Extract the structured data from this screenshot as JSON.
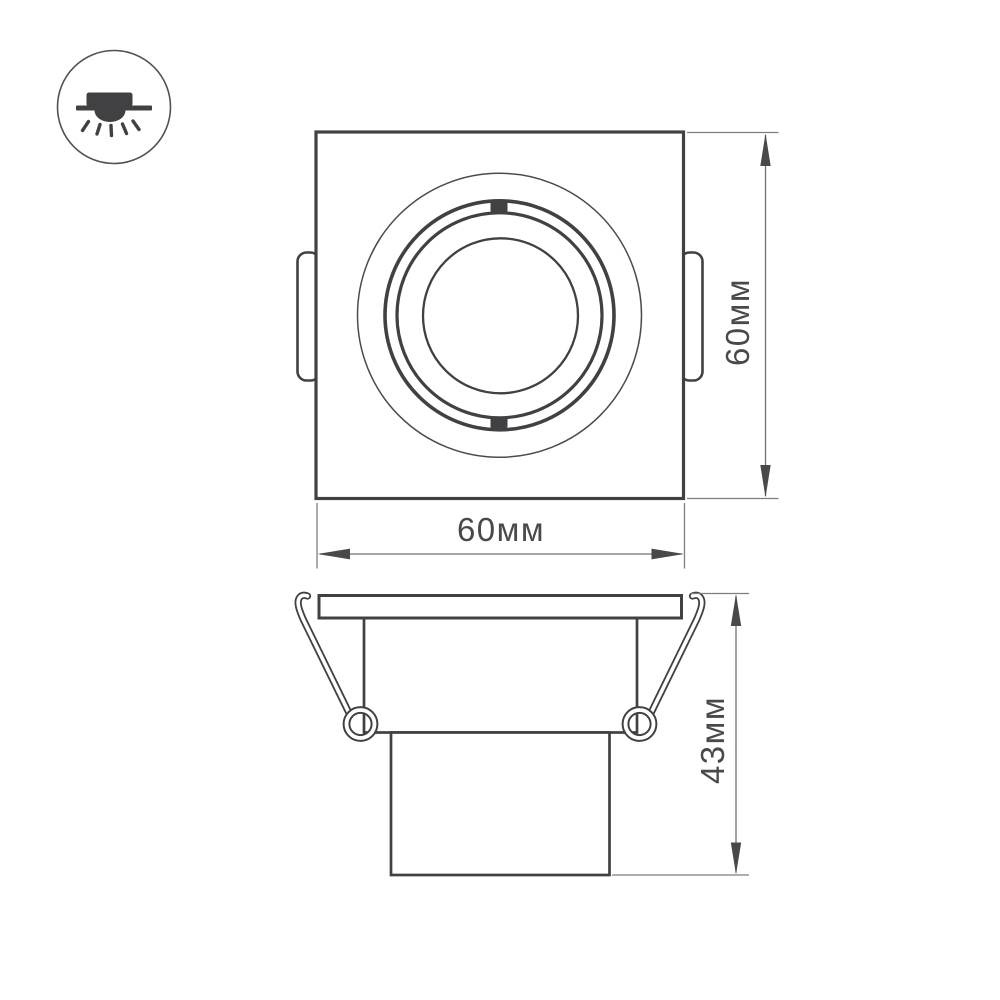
{
  "drawing": {
    "icon": {
      "name": "recessed-downlight-icon"
    },
    "labels": {
      "top_height": "60мм",
      "top_width": "60мм",
      "side_height": "43мм"
    },
    "colors": {
      "outline": "#414143",
      "extension_line": "#7d7e80",
      "dimension_line": "#6f7072",
      "arrow": "#48494b",
      "text": "#48494b",
      "icon_circle": "#515254",
      "background": "#ffffff"
    }
  }
}
